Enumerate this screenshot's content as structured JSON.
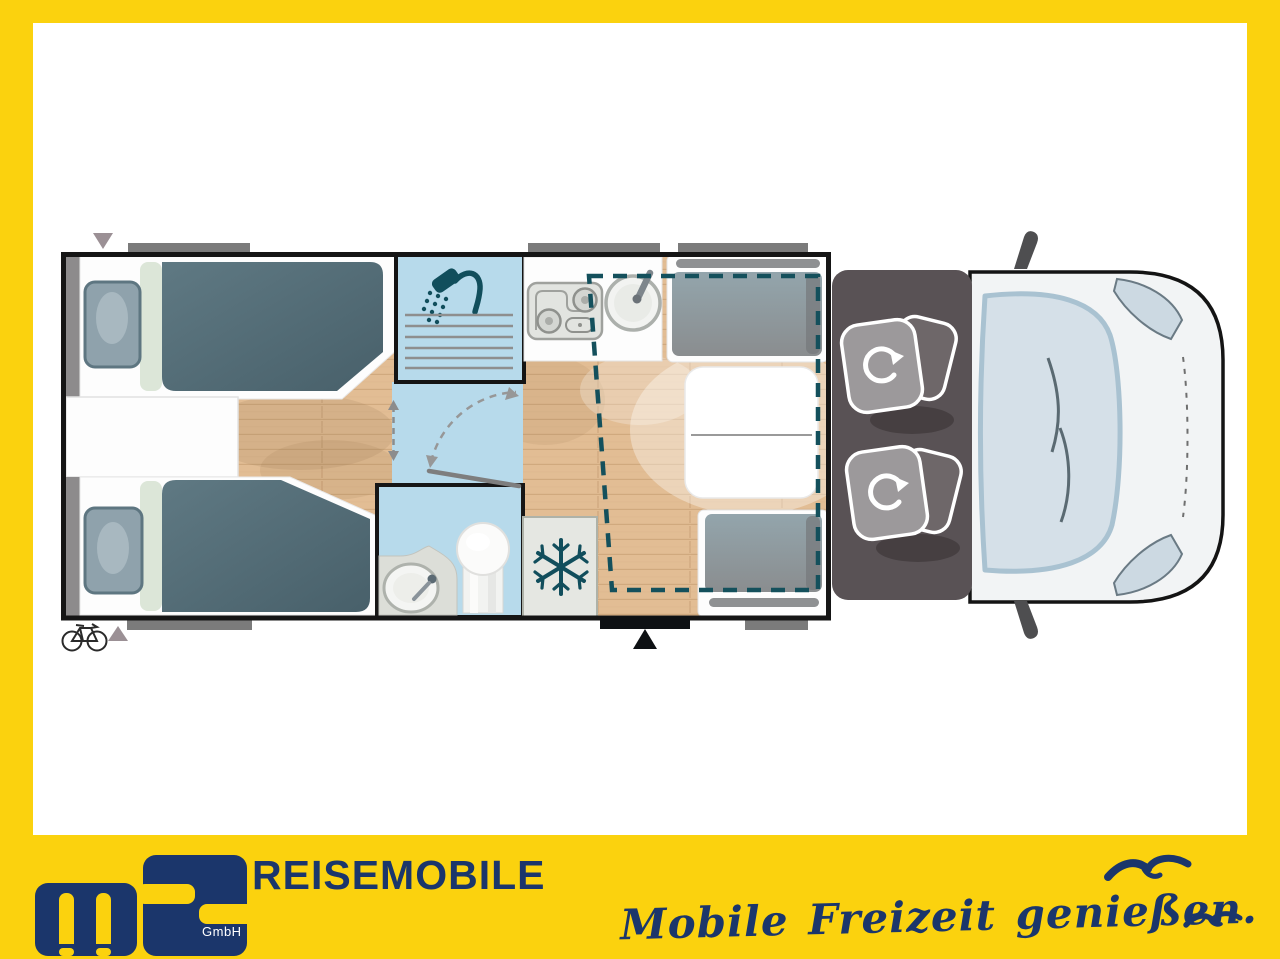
{
  "branding": {
    "logo_text": "MS",
    "company_suffix": "GmbH",
    "wordmark": "REISEMOBILE",
    "tagline": "Mobile Freizeit genießen."
  },
  "colors": {
    "frame_yellow": "#FBD20E",
    "brand_navy": "#1B366B",
    "floor_wood": "#E2BD94",
    "wet_room_blue": "#B7DAEB",
    "mattress_slate": "#54707B",
    "cushion_gray": "#8E9296",
    "cab_gray": "#595255",
    "icon_teal": "#114E5C",
    "wall_black": "#151515",
    "vehicle_body_white": "#F2F4F5",
    "windshield_blue": "#D5E0E8",
    "awning_bar_gray": "#7B7B7B"
  },
  "floorplan": {
    "icons": [
      "shower-icon",
      "snowflake-icon",
      "bicycle-icon",
      "swivel-seat-rotation-icon",
      "entry-door-arrow-icon",
      "sliding-door-arrows-icon",
      "door-swing-arc-icon",
      "marker-triangle-icon",
      "mirror-icon"
    ],
    "areas": [
      "twin-single-beds-rear",
      "shower-cubicle",
      "washroom-toilet-sink",
      "refrigerator",
      "kitchen-hob-and-sink",
      "dinette-two-benches-and-table",
      "drop-down-bed-dashed-outline",
      "entry-door-step",
      "driver-cab-swivel-seats",
      "vehicle-front-windshield"
    ]
  }
}
